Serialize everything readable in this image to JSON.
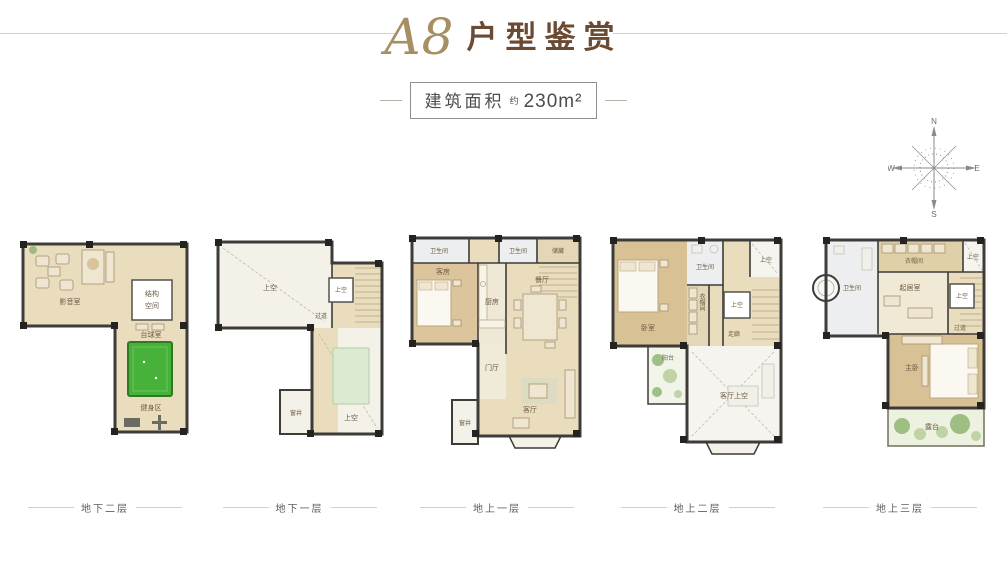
{
  "header": {
    "title_code": "A8",
    "title_text": "户型鉴赏",
    "area_label": "建筑面积",
    "area_approx": "约",
    "area_value": "230m²"
  },
  "compass": {
    "n": "N",
    "e": "E",
    "s": "S",
    "w": "W"
  },
  "plans": [
    {
      "caption": "地下二层",
      "rooms": {
        "media_room": "影音室",
        "structure_line1": "结构",
        "structure_line2": "空间",
        "billiards_room": "台球室",
        "gym_area": "健身区"
      }
    },
    {
      "caption": "地下一层",
      "rooms": {
        "void_above": "上空",
        "corridor": "过道",
        "stair_void": "上空",
        "void_bottom": "上空",
        "window_well": "窗井"
      }
    },
    {
      "caption": "地上一层",
      "rooms": {
        "bathroom_1": "卫生间",
        "bathroom_2": "卫生间",
        "storage": "储藏",
        "guest_room": "客房",
        "kitchen": "厨房",
        "dining_room": "餐厅",
        "foyer": "门厅",
        "window_well": "窗井",
        "living_room": "客厅"
      }
    },
    {
      "caption": "地上二层",
      "rooms": {
        "bedroom": "卧室",
        "bathroom": "卫生间",
        "closet": "衣帽间",
        "corner_void": "上空",
        "stair_void": "上空",
        "corridor": "走廊",
        "balcony": "阳台",
        "living_void": "客厅上空"
      }
    },
    {
      "caption": "地上三层",
      "rooms": {
        "closet": "衣帽间",
        "corner_void": "上空",
        "bathroom": "卫生间",
        "family_room": "起居室",
        "stair_void": "上空",
        "corridor": "过道",
        "master_bedroom": "主卧",
        "terrace": "露台"
      }
    }
  ],
  "colors": {
    "title_gold": "#a78e63",
    "title_brown": "#6b4a33",
    "wall": "#3e3c38",
    "floor_tan": "#e9ddbe",
    "floor_wood": "#d9c196",
    "pool_green": "#46b23a"
  }
}
